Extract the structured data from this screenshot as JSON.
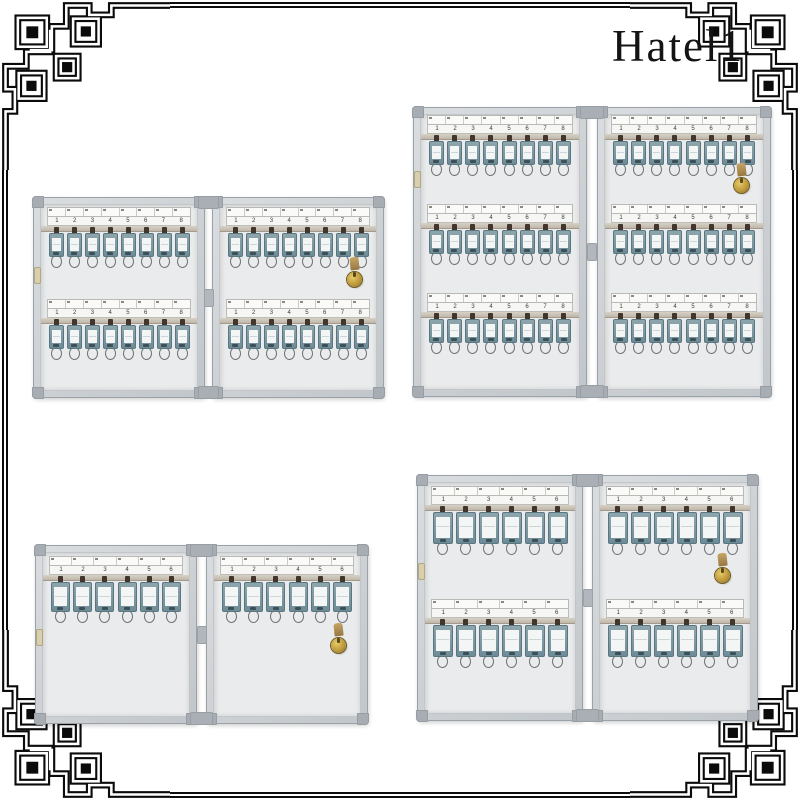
{
  "brand": {
    "name": "Hatel1"
  },
  "frame": {
    "style": "chinese-fret-border",
    "color": "#0b0b0b"
  },
  "colors": {
    "tag_body": "#7b97a1",
    "tag_label": "#f4f6f5",
    "cabinet_aluminum": "#c9cdd1",
    "lock_brass": "#c4a23f",
    "rail": "#cbc4b6"
  },
  "products": [
    {
      "name": "key cabinet 32 hooks",
      "position": "top-left",
      "panels": 2,
      "rows_per_panel": 2,
      "hooks_per_row": 8,
      "capacity": 32,
      "slot_numbers": [
        "1",
        "2",
        "3",
        "4",
        "5",
        "6",
        "7",
        "8"
      ],
      "has_lock": true,
      "has_latch": true
    },
    {
      "name": "key cabinet 48 hooks",
      "position": "top-right",
      "panels": 2,
      "rows_per_panel": 3,
      "hooks_per_row": 8,
      "capacity": 48,
      "slot_numbers": [
        "1",
        "2",
        "3",
        "4",
        "5",
        "6",
        "7",
        "8"
      ],
      "has_lock": true,
      "has_latch": true
    },
    {
      "name": "key cabinet 12 hooks",
      "position": "bottom-left",
      "panels": 2,
      "rows_per_panel": 1,
      "hooks_per_row": 6,
      "capacity": 12,
      "slot_numbers": [
        "1",
        "2",
        "3",
        "4",
        "5",
        "6"
      ],
      "has_lock": true,
      "has_latch": true
    },
    {
      "name": "key cabinet 24 hooks",
      "position": "bottom-right",
      "panels": 2,
      "rows_per_panel": 2,
      "hooks_per_row": 6,
      "capacity": 24,
      "slot_numbers": [
        "1",
        "2",
        "3",
        "4",
        "5",
        "6"
      ],
      "has_lock": true,
      "has_latch": true
    }
  ]
}
